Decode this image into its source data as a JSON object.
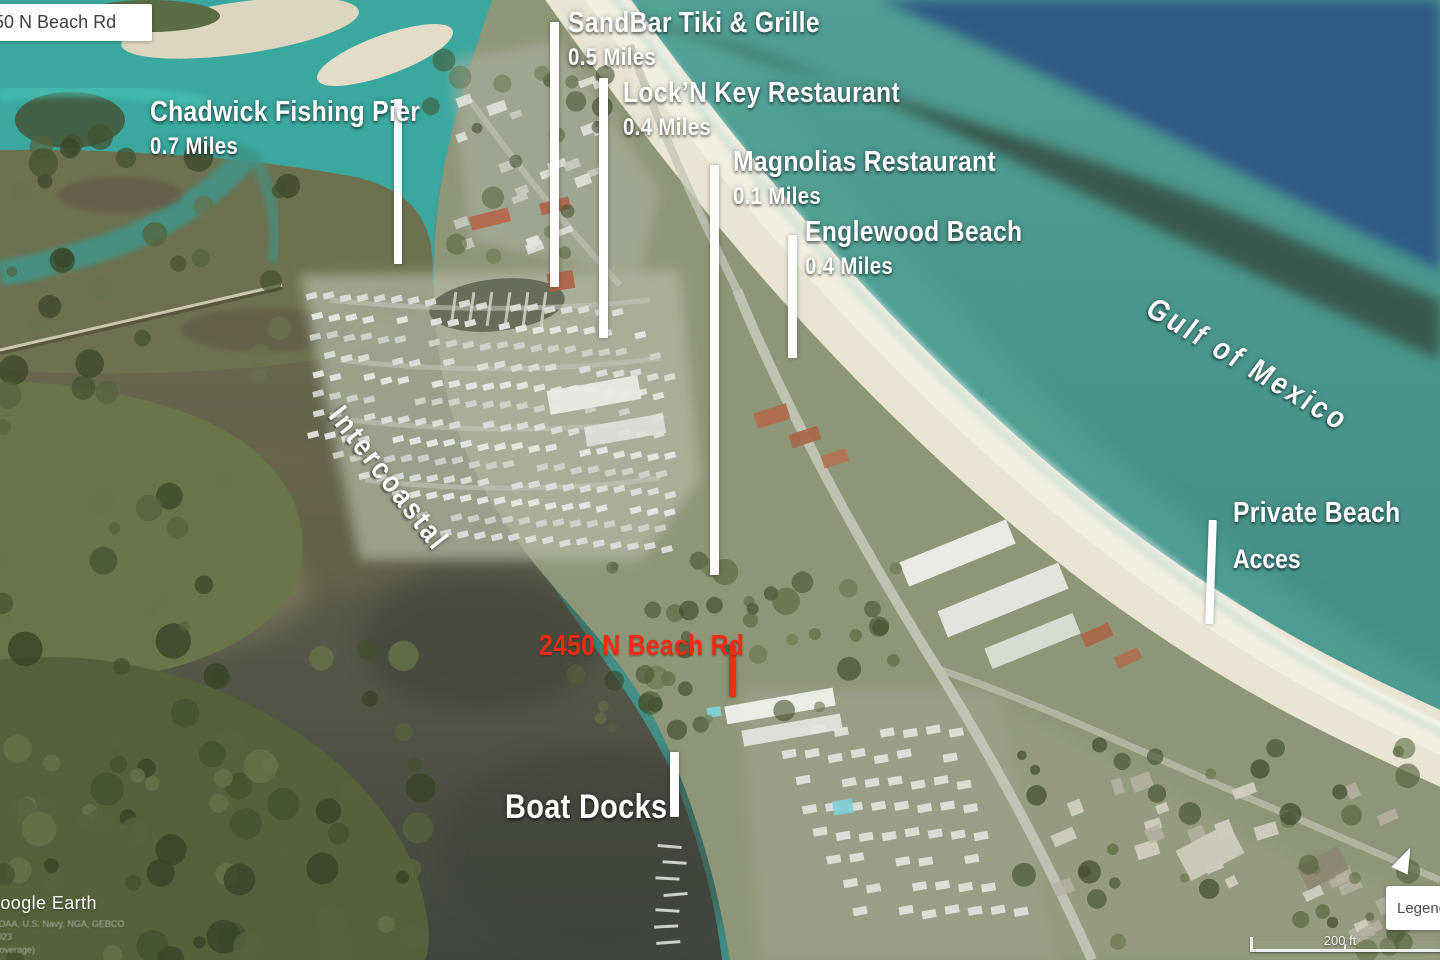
{
  "search_label": {
    "text": "2450 N Beach Rd"
  },
  "annotations": {
    "chadwick": {
      "title": "Chadwick Fishing Pier",
      "distance": "0.7 Miles"
    },
    "sandbar": {
      "title": "SandBar Tiki & Grille",
      "distance": "0.5 Miles"
    },
    "lock_n_key": {
      "title": "Lock’N Key Restaurant",
      "distance": "0.4 Miles"
    },
    "magnolias": {
      "title": "Magnolias Restaurant",
      "distance": "0.1 Miles"
    },
    "englewood": {
      "title": "Englewood Beach",
      "distance": "0.4 Miles"
    },
    "private_beach": {
      "line1": "Private Beach",
      "line2": "Acces"
    },
    "property": {
      "title": "2450 N Beach Rd"
    },
    "boat_docks": {
      "title": "Boat Docks"
    },
    "gulf": {
      "title": "Gulf of Mexico"
    },
    "intercoastal": {
      "title": "Intercoastal"
    }
  },
  "watermark": {
    "logo": "Google Earth",
    "credits": [
      "NOAA, U.S. Navy, NGA, GEBCO",
      "2023",
      "(coverage)"
    ]
  },
  "scale_bar": {
    "label": "200 ft"
  },
  "legend": {
    "label": "Legend"
  },
  "colors": {
    "annotation_white": "#ffffff",
    "annotation_red": "#f32b15",
    "gulf_teal": "#47948a",
    "deep_blue": "#2f5a85",
    "bay_olive": "#6e6b50",
    "sand": "#e9e4d3"
  }
}
